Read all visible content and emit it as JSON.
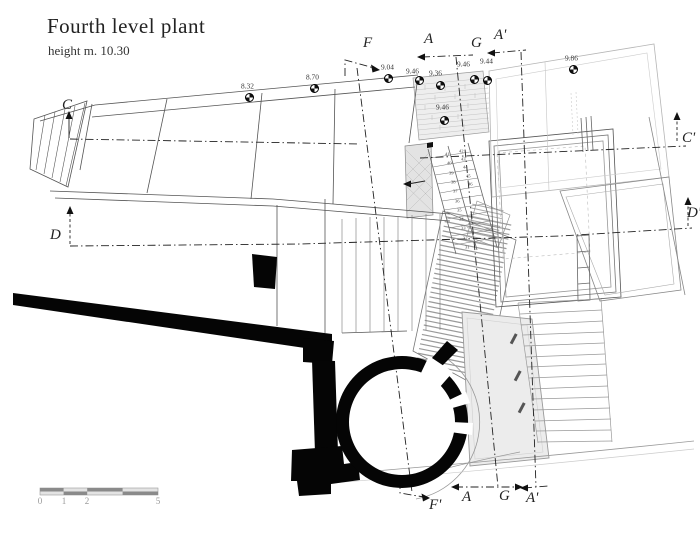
{
  "title": "Fourth level plant",
  "subtitle": "height m. 10.30",
  "colors": {
    "line": "#444444",
    "light_line": "#aaaaaa",
    "poche": "#050505",
    "hatch": "#999999",
    "accent": "#222222"
  },
  "section_markers": [
    {
      "id": "f-top",
      "label": "F",
      "x": 363,
      "y": 36
    },
    {
      "id": "a-top",
      "label": "A",
      "x": 424,
      "y": 32
    },
    {
      "id": "g-top",
      "label": "G",
      "x": 471,
      "y": 36
    },
    {
      "id": "a-prime-top",
      "label": "A'",
      "x": 494,
      "y": 28
    },
    {
      "id": "c-left",
      "label": "C",
      "x": 62,
      "y": 98
    },
    {
      "id": "d-left",
      "label": "D",
      "x": 50,
      "y": 228
    },
    {
      "id": "c-prime-right",
      "label": "C'",
      "x": 682,
      "y": 131
    },
    {
      "id": "d-prime-right",
      "label": "D'",
      "x": 687,
      "y": 206
    },
    {
      "id": "f-prime-bottom",
      "label": "F'",
      "x": 429,
      "y": 498
    },
    {
      "id": "a-bottom",
      "label": "A",
      "x": 462,
      "y": 490
    },
    {
      "id": "g-bottom",
      "label": "G",
      "x": 499,
      "y": 489
    },
    {
      "id": "a-prime-bottom",
      "label": "A'",
      "x": 526,
      "y": 491
    }
  ],
  "elevation_points": [
    {
      "value": "8.32",
      "tx": 241,
      "ty": 83,
      "sx": 249,
      "sy": 97
    },
    {
      "value": "8.70",
      "tx": 306,
      "ty": 74,
      "sx": 314,
      "sy": 88
    },
    {
      "value": "9.04",
      "tx": 381,
      "ty": 64,
      "sx": 388,
      "sy": 78
    },
    {
      "value": "9.46",
      "tx": 406,
      "ty": 68,
      "sx": 419,
      "sy": 80
    },
    {
      "value": "9.36",
      "tx": 429,
      "ty": 70,
      "sx": 440,
      "sy": 85
    },
    {
      "value": "9.46",
      "tx": 457,
      "ty": 61,
      "sx": 474,
      "sy": 79
    },
    {
      "value": "9.44",
      "tx": 480,
      "ty": 58,
      "sx": 487,
      "sy": 80
    },
    {
      "value": "9.86",
      "tx": 565,
      "ty": 55,
      "sx": 573,
      "sy": 69
    },
    {
      "value": "9.46",
      "tx": 436,
      "ty": 104,
      "sx": 444,
      "sy": 120
    }
  ],
  "step_numbers": {
    "down_flight": {
      "values": [
        "41",
        "40",
        "39",
        "38",
        "37",
        "36",
        "35",
        "34",
        "33",
        "32",
        "31"
      ],
      "x": 445,
      "y": 152,
      "dx": 2.0,
      "dy": 9.3
    },
    "up_flight": {
      "values": [
        "42",
        "43",
        "44",
        "45",
        "46"
      ],
      "x": 459,
      "y": 149,
      "dx": 2.2,
      "dy": 8.2
    }
  },
  "scale_bar": {
    "labels": [
      {
        "text": "0",
        "x": 40
      },
      {
        "text": "1",
        "x": 64
      },
      {
        "text": "2",
        "x": 87
      },
      {
        "text": "5",
        "x": 158
      }
    ],
    "label_y": 497
  }
}
